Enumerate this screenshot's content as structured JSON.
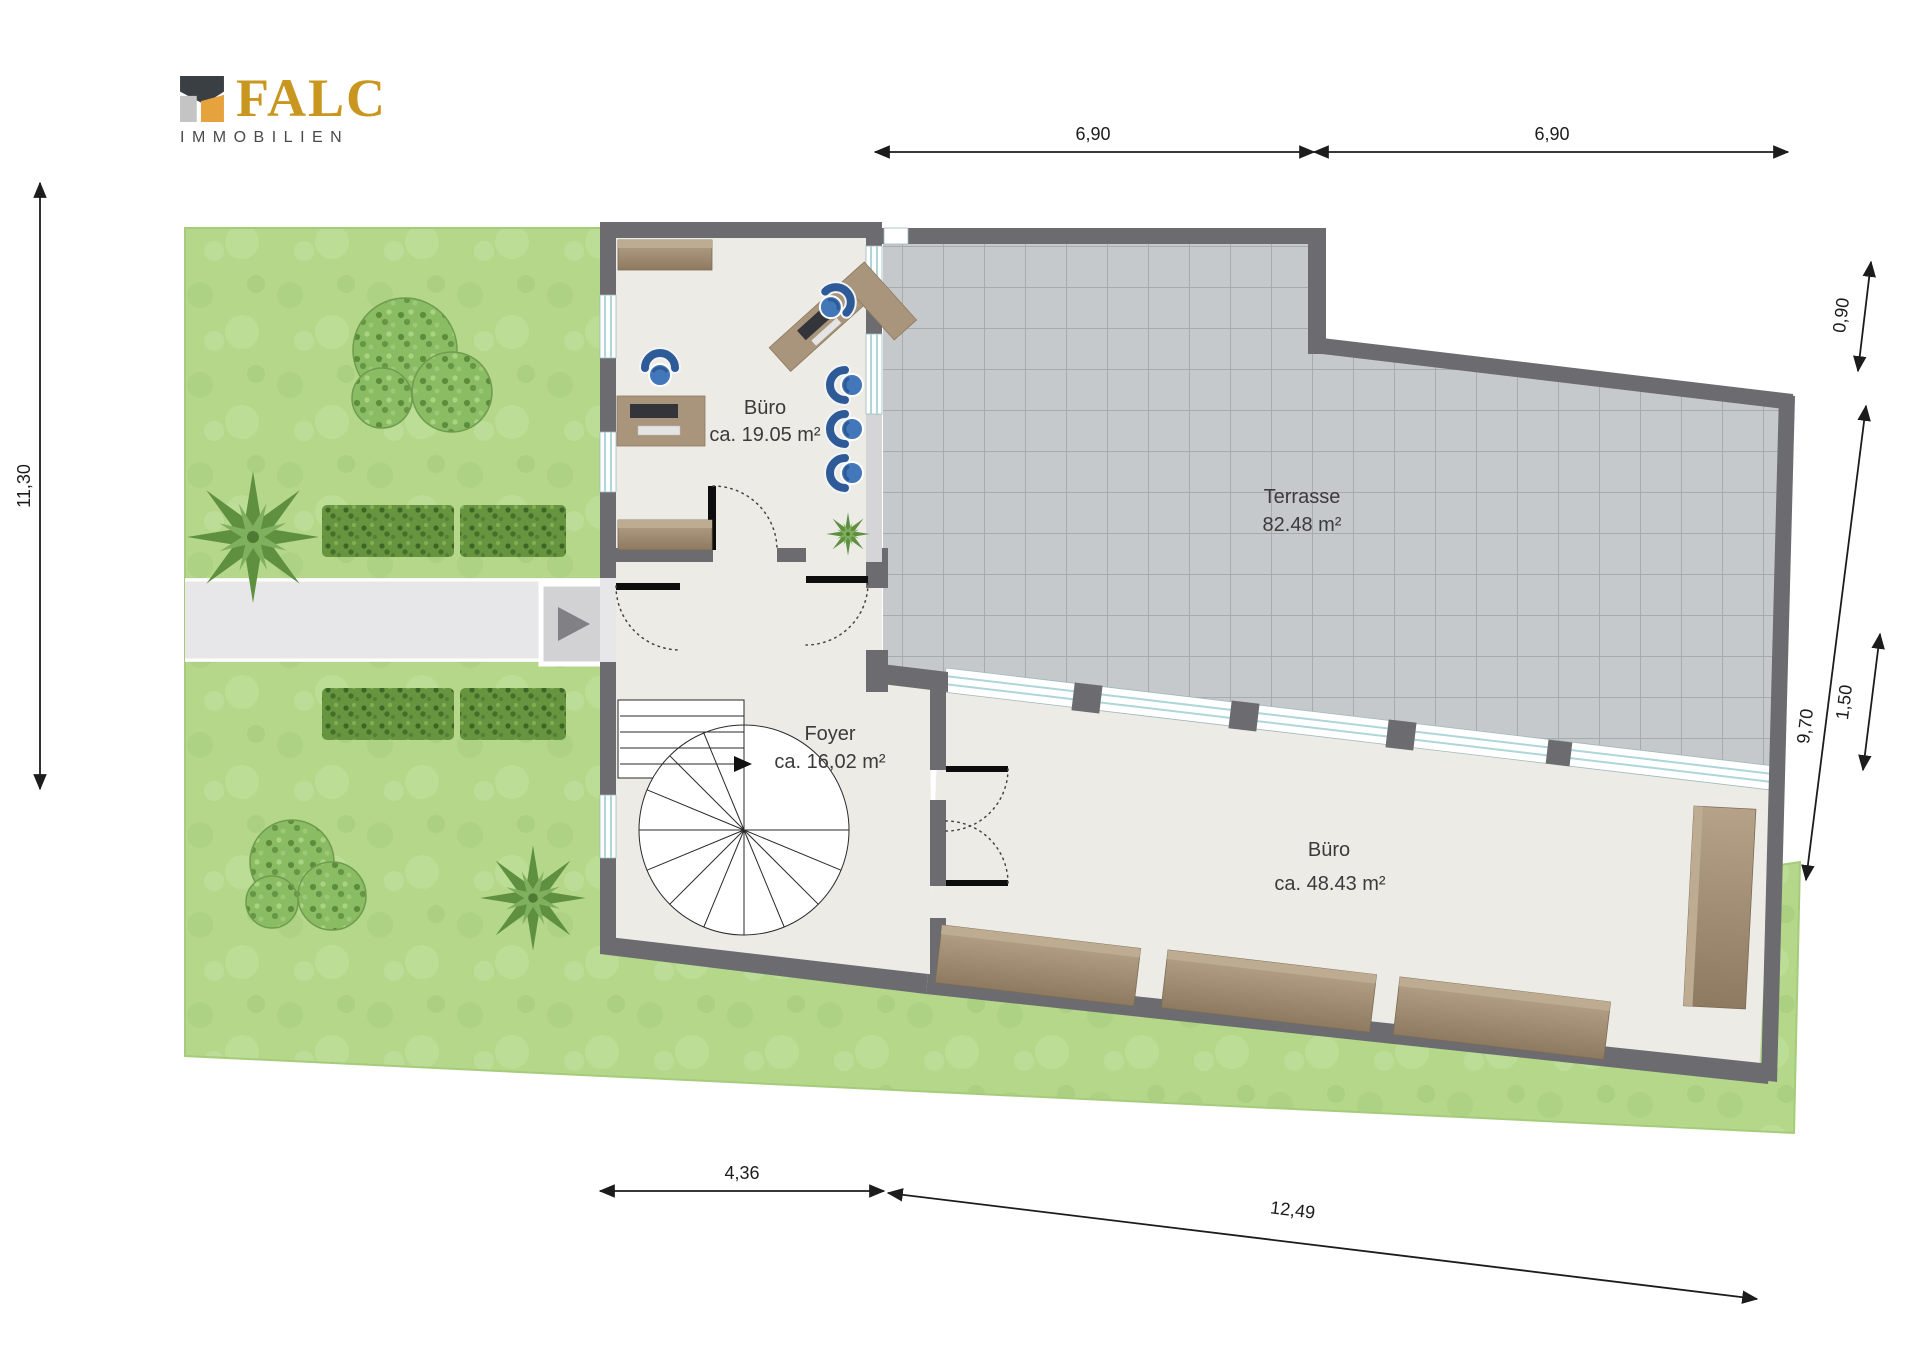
{
  "logo": {
    "brand": "FALC",
    "subtitle": "IMMOBILIEN"
  },
  "rooms": [
    {
      "id": "buero-klein",
      "name": "Büro",
      "area": "ca. 19.05 m²"
    },
    {
      "id": "terrasse",
      "name": "Terrasse",
      "area": "82.48 m²"
    },
    {
      "id": "foyer",
      "name": "Foyer",
      "area": "ca. 16,02 m²"
    },
    {
      "id": "buero-gross",
      "name": "Büro",
      "area": "ca. 48.43 m²"
    }
  ],
  "dimensions": {
    "top_left": "6,90",
    "top_right": "6,90",
    "left": "11,30",
    "right_step": "0,90",
    "right_main": "9,70",
    "right_inner": "1,50",
    "bottom_left": "4,36",
    "bottom_right": "12,49"
  },
  "icons": {
    "entrance_marker": "right-arrow",
    "logo_mark": "falc-house"
  },
  "colors": {
    "wall": "#6b6b70",
    "floor": "#edebe6",
    "terrace_tile": "#c6c9cc",
    "grass": "#b4d78a",
    "wood": "#a18d72",
    "chair_blue": "#3e6cab",
    "path": "#e7e7e9",
    "logo_gold": "#c9971f",
    "logo_dark": "#3a3f44"
  }
}
